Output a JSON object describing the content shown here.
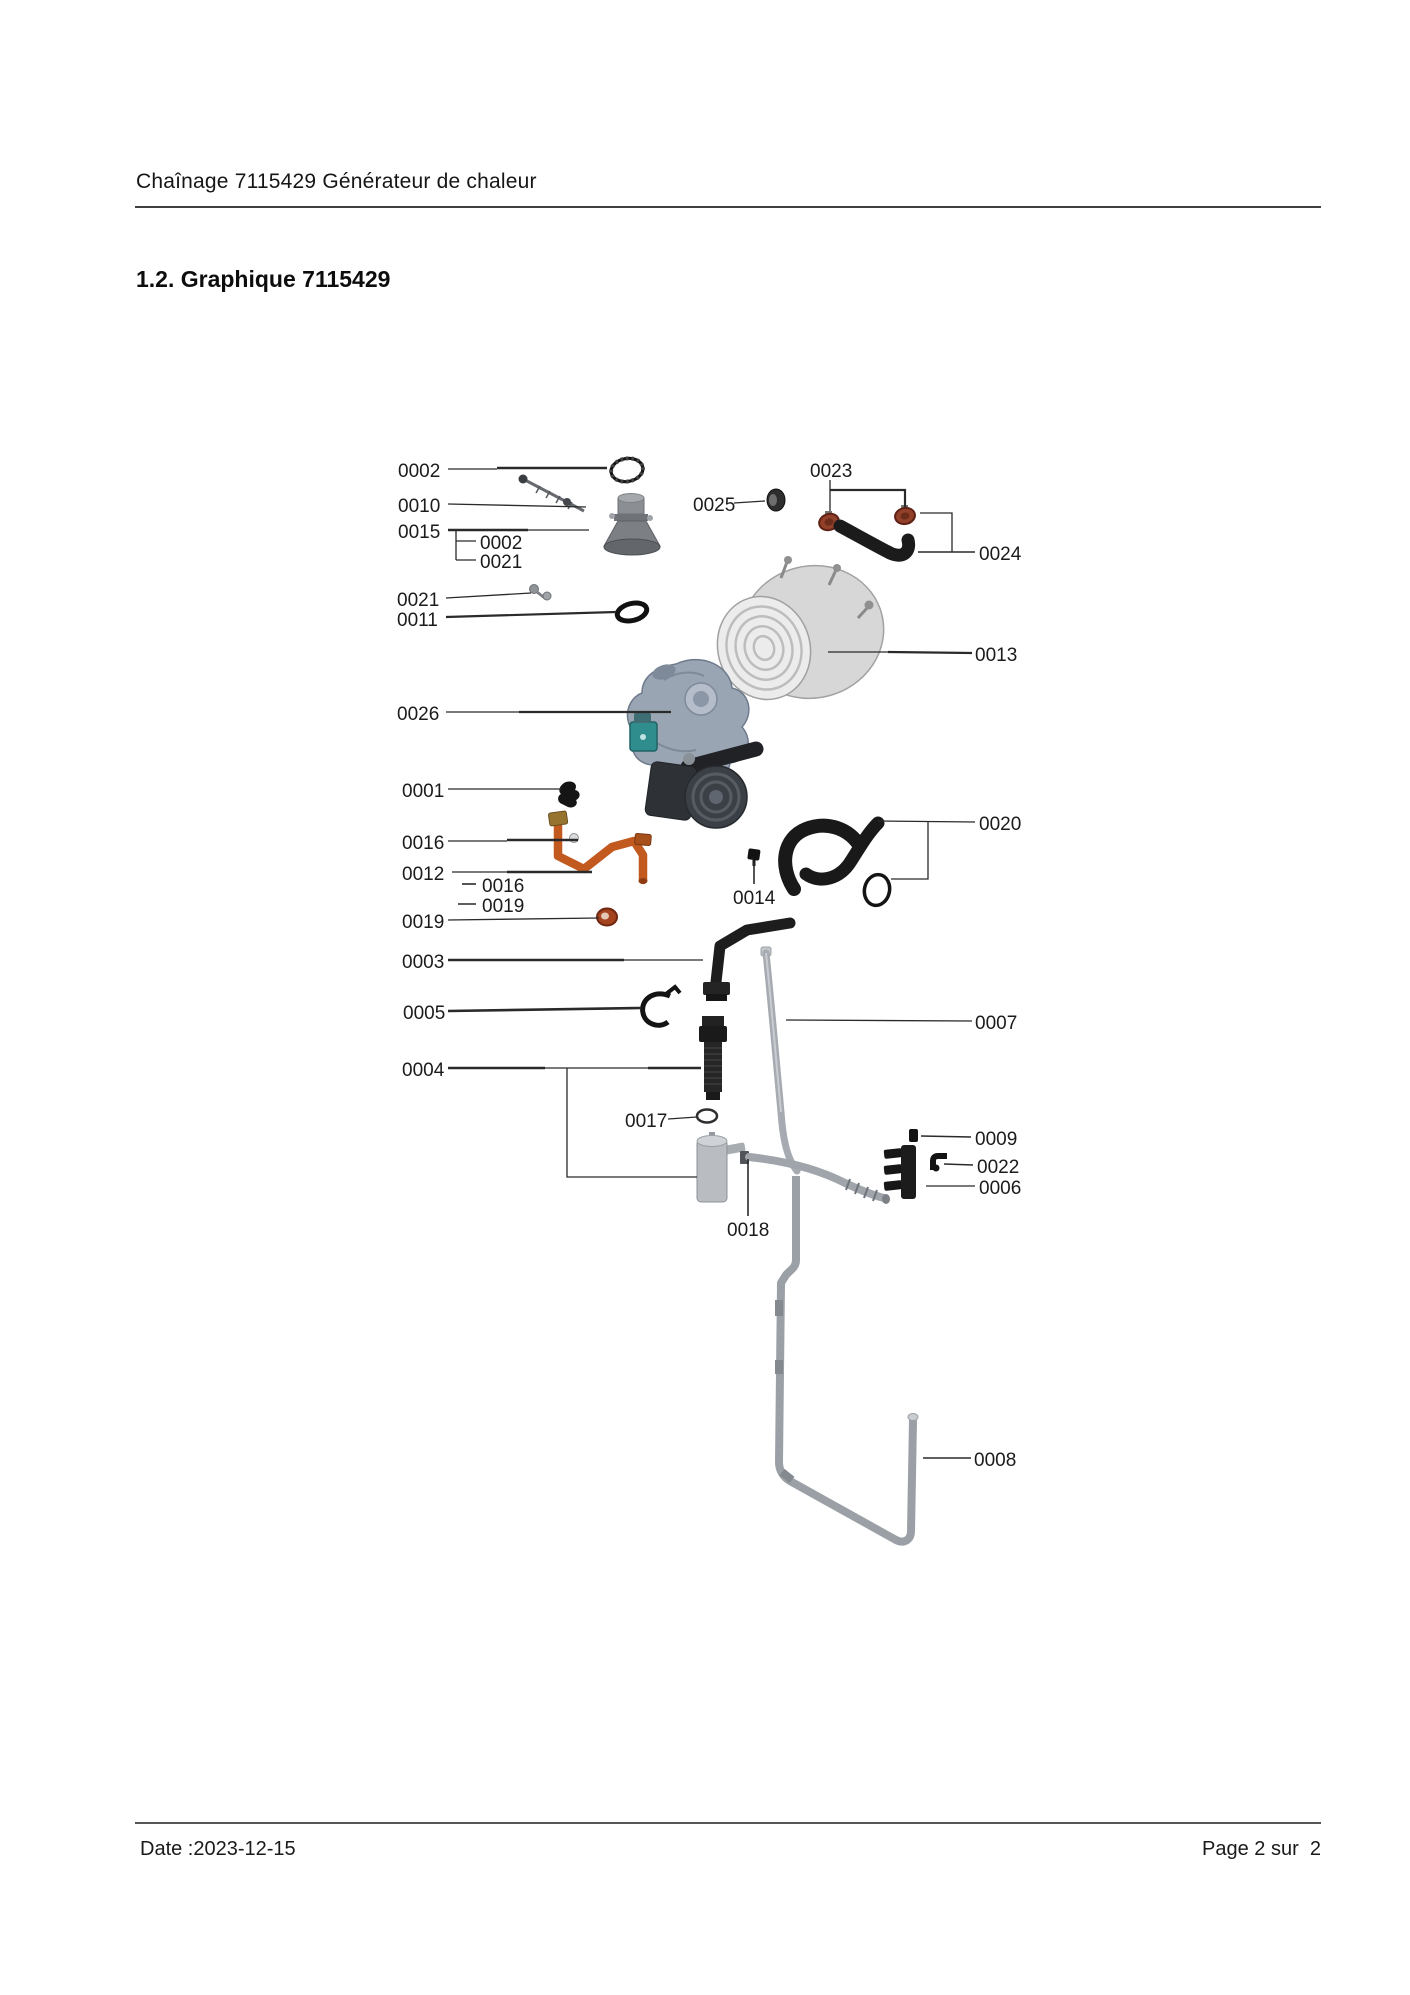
{
  "header": {
    "title": "Chaînage 7115429 Générateur de chaleur"
  },
  "section": {
    "title": "1.2. Graphique 7115429"
  },
  "footer": {
    "date": "Date :2023-12-15",
    "page": "Page 2 sur  2"
  },
  "diagram": {
    "label_color": "#1b1b1b",
    "leader_color": "#2a2a2a",
    "label_font_size": 19,
    "labels": [
      {
        "text": "0002",
        "x": 398,
        "y": 477
      },
      {
        "text": "0010",
        "x": 398,
        "y": 512
      },
      {
        "text": "0015",
        "x": 398,
        "y": 538
      },
      {
        "text": "0002",
        "x": 480,
        "y": 549
      },
      {
        "text": "0021",
        "x": 480,
        "y": 568
      },
      {
        "text": "0021",
        "x": 397,
        "y": 606
      },
      {
        "text": "0011",
        "x": 397,
        "y": 626
      },
      {
        "text": "0026",
        "x": 397,
        "y": 720
      },
      {
        "text": "0001",
        "x": 402,
        "y": 797
      },
      {
        "text": "0016",
        "x": 402,
        "y": 849
      },
      {
        "text": "0012",
        "x": 402,
        "y": 880
      },
      {
        "text": "0016",
        "x": 482,
        "y": 892
      },
      {
        "text": "0019",
        "x": 482,
        "y": 912
      },
      {
        "text": "0019",
        "x": 402,
        "y": 928
      },
      {
        "text": "0003",
        "x": 402,
        "y": 968
      },
      {
        "text": "0005",
        "x": 403,
        "y": 1019
      },
      {
        "text": "0004",
        "x": 402,
        "y": 1076
      },
      {
        "text": "0017",
        "x": 625,
        "y": 1127
      },
      {
        "text": "0018",
        "x": 727,
        "y": 1236
      },
      {
        "text": "0009",
        "x": 975,
        "y": 1145
      },
      {
        "text": "0022",
        "x": 977,
        "y": 1173
      },
      {
        "text": "0006",
        "x": 979,
        "y": 1194
      },
      {
        "text": "0007",
        "x": 975,
        "y": 1029
      },
      {
        "text": "0008",
        "x": 974,
        "y": 1466
      },
      {
        "text": "0013",
        "x": 975,
        "y": 661
      },
      {
        "text": "0024",
        "x": 979,
        "y": 560
      },
      {
        "text": "0025",
        "x": 693,
        "y": 511
      },
      {
        "text": "0023",
        "x": 810,
        "y": 477
      },
      {
        "text": "0020",
        "x": 979,
        "y": 830
      },
      {
        "text": "0014",
        "x": 733,
        "y": 904
      }
    ],
    "leaders": [
      {
        "pts": [
          [
            448,
            469
          ],
          [
            497,
            469
          ]
        ],
        "w": 1.3
      },
      {
        "pts": [
          [
            497,
            468
          ],
          [
            607,
            468
          ]
        ],
        "w": 2.6
      },
      {
        "pts": [
          [
            448,
            504
          ],
          [
            586,
            507
          ]
        ],
        "w": 1.3
      },
      {
        "pts": [
          [
            448,
            530
          ],
          [
            528,
            530
          ]
        ],
        "w": 2.6
      },
      {
        "pts": [
          [
            528,
            530
          ],
          [
            589,
            530
          ]
        ],
        "w": 1.3
      },
      {
        "pts": [
          [
            456,
            531
          ],
          [
            456,
            560
          ]
        ],
        "w": 1.3
      },
      {
        "pts": [
          [
            456,
            541
          ],
          [
            476,
            541
          ]
        ],
        "w": 1.3
      },
      {
        "pts": [
          [
            456,
            560
          ],
          [
            476,
            560
          ]
        ],
        "w": 1.3
      },
      {
        "pts": [
          [
            446,
            598
          ],
          [
            531,
            593
          ]
        ],
        "w": 1.3
      },
      {
        "pts": [
          [
            446,
            617
          ],
          [
            616,
            612
          ]
        ],
        "w": 2.2
      },
      {
        "pts": [
          [
            446,
            712
          ],
          [
            519,
            712
          ]
        ],
        "w": 1.3
      },
      {
        "pts": [
          [
            519,
            712
          ],
          [
            671,
            712
          ]
        ],
        "w": 2.2
      },
      {
        "pts": [
          [
            448,
            789
          ],
          [
            561,
            789
          ]
        ],
        "w": 1.3
      },
      {
        "pts": [
          [
            448,
            841
          ],
          [
            507,
            841
          ]
        ],
        "w": 1.3
      },
      {
        "pts": [
          [
            507,
            840
          ],
          [
            578,
            840
          ]
        ],
        "w": 2.6
      },
      {
        "pts": [
          [
            452,
            872
          ],
          [
            507,
            872
          ]
        ],
        "w": 1.3
      },
      {
        "pts": [
          [
            507,
            872
          ],
          [
            592,
            872
          ]
        ],
        "w": 2.6
      },
      {
        "pts": [
          [
            462,
            884
          ],
          [
            476,
            884
          ]
        ],
        "w": 1.6
      },
      {
        "pts": [
          [
            458,
            904
          ],
          [
            476,
            904
          ]
        ],
        "w": 1.6
      },
      {
        "pts": [
          [
            448,
            920
          ],
          [
            599,
            918
          ]
        ],
        "w": 1.3
      },
      {
        "pts": [
          [
            448,
            960
          ],
          [
            624,
            960
          ]
        ],
        "w": 2.4
      },
      {
        "pts": [
          [
            624,
            960
          ],
          [
            703,
            960
          ]
        ],
        "w": 1.3
      },
      {
        "pts": [
          [
            448,
            1011
          ],
          [
            641,
            1008
          ]
        ],
        "w": 2.6
      },
      {
        "pts": [
          [
            448,
            1068
          ],
          [
            545,
            1068
          ]
        ],
        "w": 2.4
      },
      {
        "pts": [
          [
            545,
            1068
          ],
          [
            648,
            1068
          ]
        ],
        "w": 1.3
      },
      {
        "pts": [
          [
            648,
            1068
          ],
          [
            701,
            1068
          ]
        ],
        "w": 2.4
      },
      {
        "pts": [
          [
            567,
            1068
          ],
          [
            567,
            1177
          ],
          [
            697,
            1177
          ]
        ],
        "w": 1.3
      },
      {
        "pts": [
          [
            668,
            1119
          ],
          [
            697,
            1117
          ]
        ],
        "w": 1.3
      },
      {
        "pts": [
          [
            748,
            1216
          ],
          [
            748,
            1159
          ]
        ],
        "w": 1.6
      },
      {
        "pts": [
          [
            921,
            1136
          ],
          [
            971,
            1137
          ]
        ],
        "w": 1.6
      },
      {
        "pts": [
          [
            944,
            1164
          ],
          [
            973,
            1165
          ]
        ],
        "w": 1.6
      },
      {
        "pts": [
          [
            926,
            1186
          ],
          [
            975,
            1186
          ]
        ],
        "w": 1.3
      },
      {
        "pts": [
          [
            786,
            1020
          ],
          [
            972,
            1021
          ]
        ],
        "w": 1.3
      },
      {
        "pts": [
          [
            923,
            1458
          ],
          [
            971,
            1458
          ]
        ],
        "w": 1.6
      },
      {
        "pts": [
          [
            828,
            652
          ],
          [
            888,
            652
          ]
        ],
        "w": 1.3
      },
      {
        "pts": [
          [
            888,
            652
          ],
          [
            972,
            653
          ]
        ],
        "w": 2.2
      },
      {
        "pts": [
          [
            918,
            552
          ],
          [
            975,
            552
          ]
        ],
        "w": 1.6
      },
      {
        "pts": [
          [
            920,
            513
          ],
          [
            952,
            513
          ],
          [
            952,
            552
          ]
        ],
        "w": 1.3
      },
      {
        "pts": [
          [
            734,
            503
          ],
          [
            765,
            501
          ]
        ],
        "w": 1.3
      },
      {
        "pts": [
          [
            830,
            480
          ],
          [
            830,
            511
          ]
        ],
        "w": 1.3
      },
      {
        "pts": [
          [
            830,
            490
          ],
          [
            905,
            490
          ],
          [
            905,
            507
          ]
        ],
        "w": 2.2
      },
      {
        "pts": [
          [
            878,
            821
          ],
          [
            975,
            822
          ]
        ],
        "w": 1.3
      },
      {
        "pts": [
          [
            928,
            822
          ],
          [
            928,
            879
          ],
          [
            891,
            879
          ]
        ],
        "w": 1.3
      },
      {
        "pts": [
          [
            754,
            884
          ],
          [
            754,
            861
          ]
        ],
        "w": 1.6
      }
    ]
  }
}
